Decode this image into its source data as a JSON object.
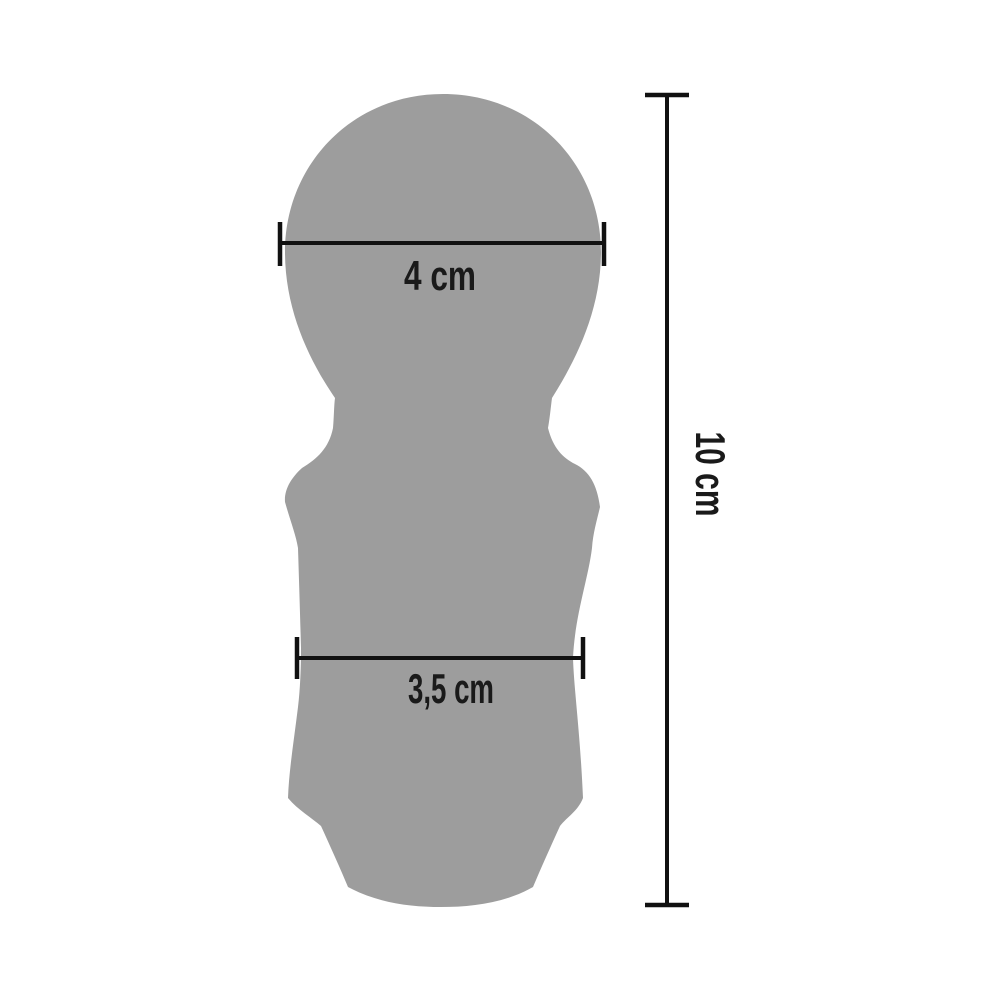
{
  "diagram": {
    "type": "product-dimension-diagram",
    "measurements": {
      "head_width": {
        "label": "4 cm",
        "value": 4,
        "unit": "cm"
      },
      "body_width": {
        "label": "3,5 cm",
        "value": 3.5,
        "unit": "cm"
      },
      "total_height": {
        "label": "10 cm",
        "value": 10,
        "unit": "cm"
      }
    },
    "colors": {
      "background": "#ffffff",
      "silhouette": "#9d9d9d",
      "dimension_line": "#111111",
      "label_text": "#1a1a1a"
    }
  }
}
